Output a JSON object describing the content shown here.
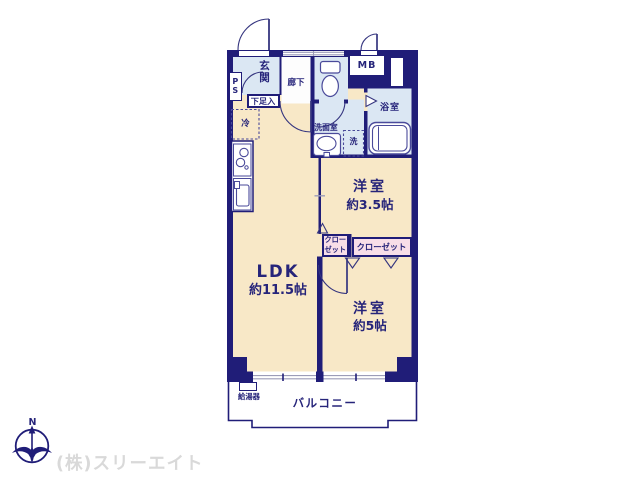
{
  "floorplan": {
    "entrance_area": {
      "genkan": "玄関",
      "hallway": "廊下",
      "pipe_space": "PS",
      "shoe_cabinet": "下足入",
      "meter_box": "MB"
    },
    "kitchen_area": {
      "refrigerator": "冷"
    },
    "sanitary": {
      "washroom": "洗面室",
      "washing_machine": "洗",
      "bathroom": "浴室"
    },
    "rooms": {
      "ldk": {
        "name": "LDK",
        "size": "約11.5帖"
      },
      "western_room_small": {
        "name": "洋室",
        "size": "約3.5帖"
      },
      "western_room_large": {
        "name": "洋室",
        "size": "約5帖"
      }
    },
    "storage": {
      "closet_small": "クロー\nゼット",
      "closet_large": "クローゼット"
    },
    "outdoor": {
      "balcony": "バルコニー",
      "water_heater": "給湯器"
    }
  },
  "compass": {
    "north_label": "N"
  },
  "footer": {
    "company_name": "(株)スリーエイト"
  },
  "colors": {
    "wall_navy": "#201d78",
    "room_cream": "#f8e8c7",
    "wet_area_blue": "#dbe7f3",
    "closet_pink": "#f8dee8",
    "label_navy": "#26247a",
    "company_gray": "#d9d9d9"
  }
}
